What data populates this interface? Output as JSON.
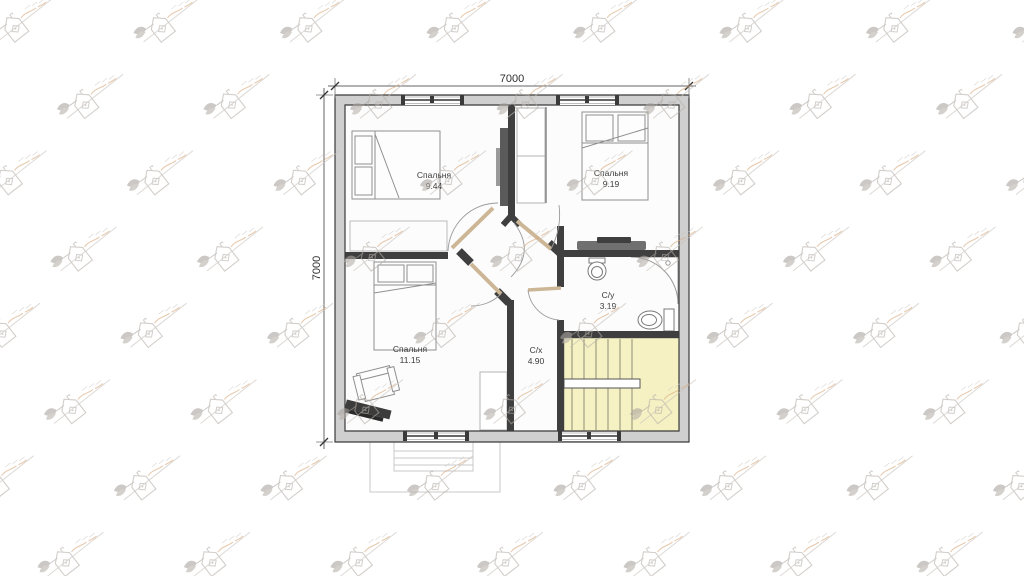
{
  "page": {
    "type": "architectural-floor-plan",
    "background": "#ffffff"
  },
  "watermark": {
    "name": "house-logo-watermark",
    "line_color": "#c6c0ba",
    "logo_color": "#b4aea8",
    "leaf_color": "#a9a39d",
    "accent_color": "#d8a87c",
    "grid": {
      "row_step": 76.3,
      "col_step": 146.5,
      "rows": 8
    }
  },
  "plan": {
    "dimensions": {
      "top": "7000",
      "left": "7000"
    },
    "rooms": [
      {
        "id": "bedroom-top-left",
        "name": "Спальня",
        "area": "9.44"
      },
      {
        "id": "bedroom-top-right",
        "name": "Спальня",
        "area": "9.19"
      },
      {
        "id": "bedroom-bottom-left",
        "name": "Спальня",
        "area": "11.15"
      },
      {
        "id": "bathroom",
        "name": "С/у",
        "area": "3.19"
      },
      {
        "id": "hallway",
        "name": "С/х",
        "area": "4.90"
      }
    ],
    "features": [
      "stairs",
      "porch",
      "beds",
      "wardrobes",
      "armchair",
      "piano",
      "desk",
      "sink",
      "shower",
      "toilet"
    ],
    "colors": {
      "wall": "#3f3f3f",
      "wall_fill": "#cfcfcf",
      "stairs_fill": "#f5f1c3",
      "door": "#ccb695",
      "floor": "#fcfcfc"
    }
  }
}
